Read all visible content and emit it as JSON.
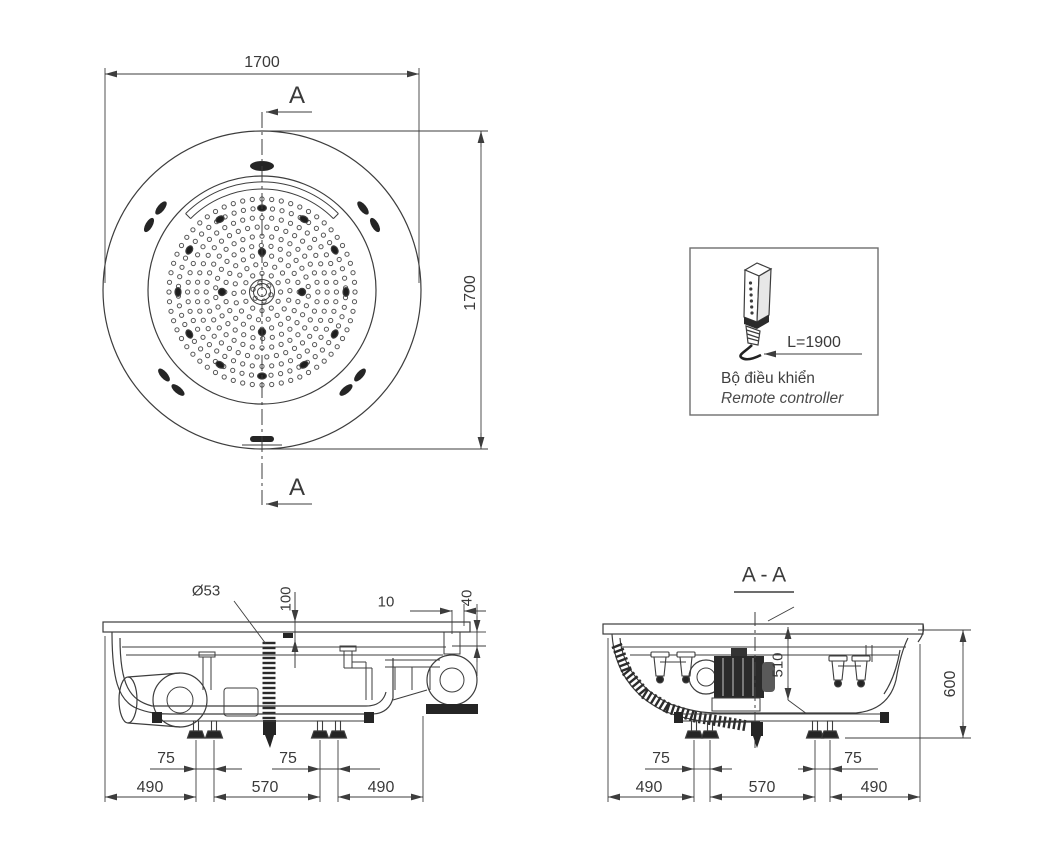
{
  "top_view": {
    "dim_width": "1700",
    "dim_height": "1700",
    "section_mark_top": "A",
    "section_mark_bottom": "A"
  },
  "remote_controller": {
    "cable_length": "L=1900",
    "label_vi": "Bộ điều khiển",
    "label_en": "Remote controller"
  },
  "side_view": {
    "hose_diameter": "Ø53",
    "dim_rim_height": "100",
    "dim_edge_gap": "10",
    "dim_apron_drop": "40",
    "dim_leg_pair_left": "75",
    "dim_leg_pair_right": "75",
    "dim_left": "490",
    "dim_center": "570",
    "dim_right": "490"
  },
  "section_view": {
    "title": "A - A",
    "dim_inner_depth": "510",
    "dim_total_height": "600",
    "dim_leg_pair_left": "75",
    "dim_leg_pair_right": "75",
    "dim_left": "490",
    "dim_center": "570",
    "dim_right": "490"
  },
  "colors": {
    "line": "#3d3d3d",
    "dark_fill": "#252525",
    "background": "#ffffff"
  }
}
